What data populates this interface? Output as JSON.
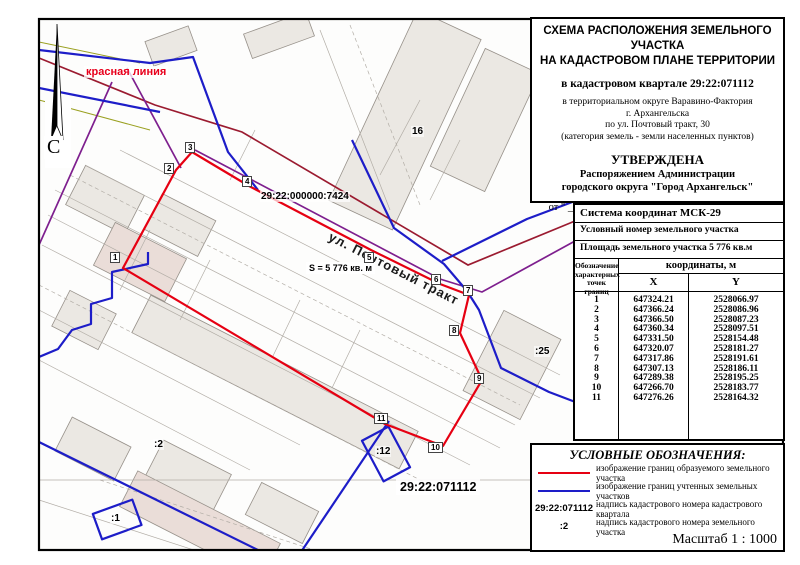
{
  "map": {
    "labels": {
      "compass": "С",
      "red_line": "красная линия",
      "parent_parcel": "29:22:000000:7424",
      "street": "ул. Почтовый тракт",
      "area": "S = 5 776 кв. м",
      "quarter": "29:22:071112",
      "p25": ":25",
      "p16": "16",
      "p2": ":2",
      "p12": ":12",
      "p1": ":1"
    },
    "vertices": [
      {
        "n": "1",
        "x": 110,
        "y": 252
      },
      {
        "n": "2",
        "x": 164,
        "y": 163
      },
      {
        "n": "3",
        "x": 185,
        "y": 142
      },
      {
        "n": "4",
        "x": 242,
        "y": 176
      },
      {
        "n": "5",
        "x": 364,
        "y": 252
      },
      {
        "n": "6",
        "x": 431,
        "y": 274
      },
      {
        "n": "7",
        "x": 463,
        "y": 285
      },
      {
        "n": "8",
        "x": 449,
        "y": 325
      },
      {
        "n": "9",
        "x": 474,
        "y": 373
      },
      {
        "n": "10",
        "x": 428,
        "y": 442
      },
      {
        "n": "11",
        "x": 374,
        "y": 413
      }
    ],
    "colors": {
      "formed_boundary": "#e60012",
      "registered_boundary": "#1d1dc8",
      "red_line": "#9b1b30",
      "red_line_alt": "#7e1f8e"
    }
  },
  "title_block": {
    "title_line1": "СХЕМА РАСПОЛОЖЕНИЯ ЗЕМЕЛЬНОГО УЧАСТКА",
    "title_line2": "НА КАДАСТРОВОМ ПЛАНЕ ТЕРРИТОРИИ",
    "quarter_line": "в кадастровом квартале 29:22:071112",
    "location_line1": "в территориальном округе Варавино-Фактория",
    "location_line2": "г. Архангельска",
    "location_line3": "по ул. Почтовый тракт, 30",
    "location_line4": "(категория земель - земли населенных пунктов)",
    "approved_heading": "УТВЕРЖДЕНА",
    "approved_line1": "Распоряжением Администрации",
    "approved_line2": "городского округа \"Город Архангельск\"",
    "date_line": "от \" ____ \" ______________ 20_____ г. № ______"
  },
  "table": {
    "coord_system": "Система координат МСК-29",
    "conditional_number": "Условный номер земельного участка",
    "area": "Площадь земельного участка 5 776 кв.м",
    "point_col_line1": "Обозначение",
    "point_col_line2": "характерных",
    "point_col_line3": "точек границ",
    "coords_header": "координаты, м",
    "x_header": "X",
    "y_header": "Y",
    "rows": [
      {
        "n": "1",
        "x": "647324.21",
        "y": "2528066.97"
      },
      {
        "n": "2",
        "x": "647366.24",
        "y": "2528086.96"
      },
      {
        "n": "3",
        "x": "647366.50",
        "y": "2528087.23"
      },
      {
        "n": "4",
        "x": "647360.34",
        "y": "2528097.51"
      },
      {
        "n": "5",
        "x": "647331.50",
        "y": "2528154.48"
      },
      {
        "n": "6",
        "x": "647320.07",
        "y": "2528181.27"
      },
      {
        "n": "7",
        "x": "647317.86",
        "y": "2528191.61"
      },
      {
        "n": "8",
        "x": "647307.13",
        "y": "2528186.11"
      },
      {
        "n": "9",
        "x": "647289.38",
        "y": "2528195.25"
      },
      {
        "n": "10",
        "x": "647266.70",
        "y": "2528183.77"
      },
      {
        "n": "11",
        "x": "647276.26",
        "y": "2528164.32"
      }
    ]
  },
  "legend": {
    "title": "УСЛОВНЫЕ ОБОЗНАЧЕНИЯ:",
    "items": [
      {
        "sample": "red-line",
        "label": "изображение границ образуемого земельного участка"
      },
      {
        "sample": "blue-line",
        "label": "изображение границ учтенных земельных участков"
      },
      {
        "sample": "quarter-number",
        "sample_text": "29:22:071112",
        "label": "надпись кадастрового номера кадастрового квартала"
      },
      {
        "sample": "parcel-number",
        "sample_text": ":2",
        "label": "надпись кадастрового номера земельного участка"
      }
    ],
    "scale": "Масштаб  1 : 1000"
  }
}
